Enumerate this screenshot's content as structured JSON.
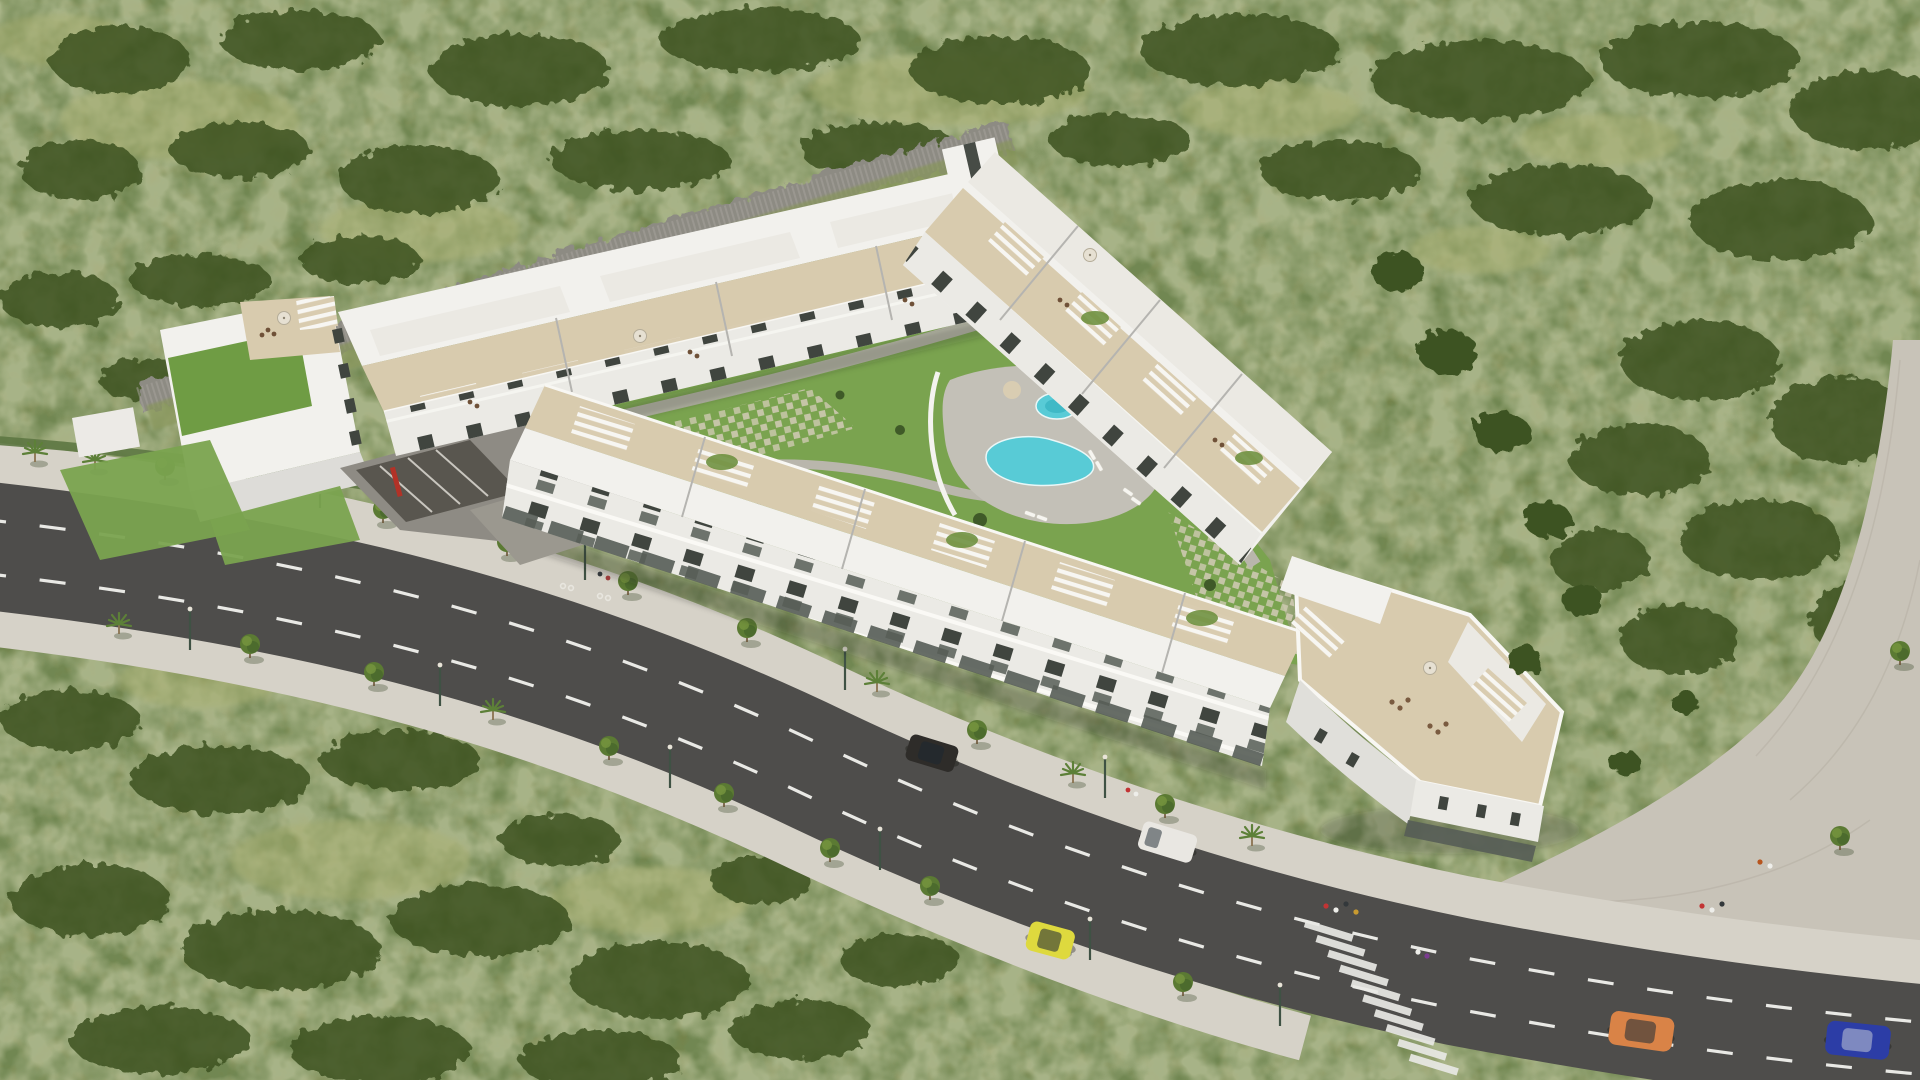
{
  "meta": {
    "scene": "Aerial 3D architectural render of a white hillside apartment complex beside a curving avenue",
    "view": "bird's-eye three-quarter aerial",
    "lighting": "bright daylight, sun from upper left"
  },
  "colors": {
    "scrub_base": "#75834a",
    "scrub_dark": "#3c5222",
    "scrub_light": "#aab173",
    "lawn": "#7aa34f",
    "building_white": "#f2f1ed",
    "building_face": "#ebeae5",
    "building_shade": "#c6c5c1",
    "terrace_beige": "#d8cbae",
    "gravel_roof": "#ebe9e3",
    "green_roof": "#6f9c44",
    "pool_water": "#58cbd6",
    "pool_deck": "#c3c0b7",
    "asphalt": "#4e4d4b",
    "lane_marking": "#e9e9e5",
    "sidewalk": "#d6d2c8",
    "cobble": "#c8c3b8",
    "rock_wall": "#8d8b83",
    "street_tree": "#53702f",
    "window_dark": "#40453f",
    "storefront_glass": "#565d56",
    "red_accent": "#b23227"
  },
  "site": {
    "hillside": "dense green Mediterranean scrub with shrub clusters and dry grass patches",
    "rock_wall": "dry-stone retaining wall running behind the upper wing",
    "promenade": "paved pedestrian path along the right boundary"
  },
  "complex": {
    "wings": [
      {
        "name": "west-block",
        "features": "green sedum roof over parking podium, roof terrace with parasol, garage ramp with red wall"
      },
      {
        "name": "northwest-wing",
        "features": "stepped blocks with beige roof terraces, white pergolas and balconied south facade"
      },
      {
        "name": "northeast-wing",
        "features": "terraced blocks stepping downhill with deep beige terraces and pergolas"
      },
      {
        "name": "south-wing",
        "features": "road-facing blocks, balcony floors over ground-floor glazing, pergola roof terraces with climbing plants"
      },
      {
        "name": "southeast-corner-building",
        "features": "large furnished roof terrace with parasol, curved corner over street-level storefronts"
      }
    ],
    "courtyard": "communal garden with lawns, winding paths, grass-paver grids and shrubs",
    "pools": [
      {
        "name": "main-pool",
        "shape": "freeform"
      },
      {
        "name": "round-pool",
        "shape": "circular"
      }
    ],
    "pool_area": "grey stone deck, white sun loungers, palm trees"
  },
  "street": {
    "road": "multi-lane asphalt avenue sweeping from the left edge to the bottom right",
    "markings": "dashed white lane lines",
    "crosswalk": "zebra crossing near the corner building",
    "sidewalks": "paved walks on both sides planted with young trees, palms and slim lampposts",
    "bike_markings": "cycle-lane symbols painted on the upper sidewalk"
  },
  "vehicles": [
    {
      "name": "yellow-hatchback",
      "hex": "#ded93e"
    },
    {
      "name": "dark-suv",
      "hex": "#2e2c29"
    },
    {
      "name": "white-van",
      "hex": "#e9e7e2"
    },
    {
      "name": "orange-hatchback",
      "hex": "#d98347"
    },
    {
      "name": "blue-sedan",
      "hex": "#2c3da6"
    }
  ],
  "people": "small pedestrian figures on the corner sidewalk, near the crosswalk and along the promenade"
}
